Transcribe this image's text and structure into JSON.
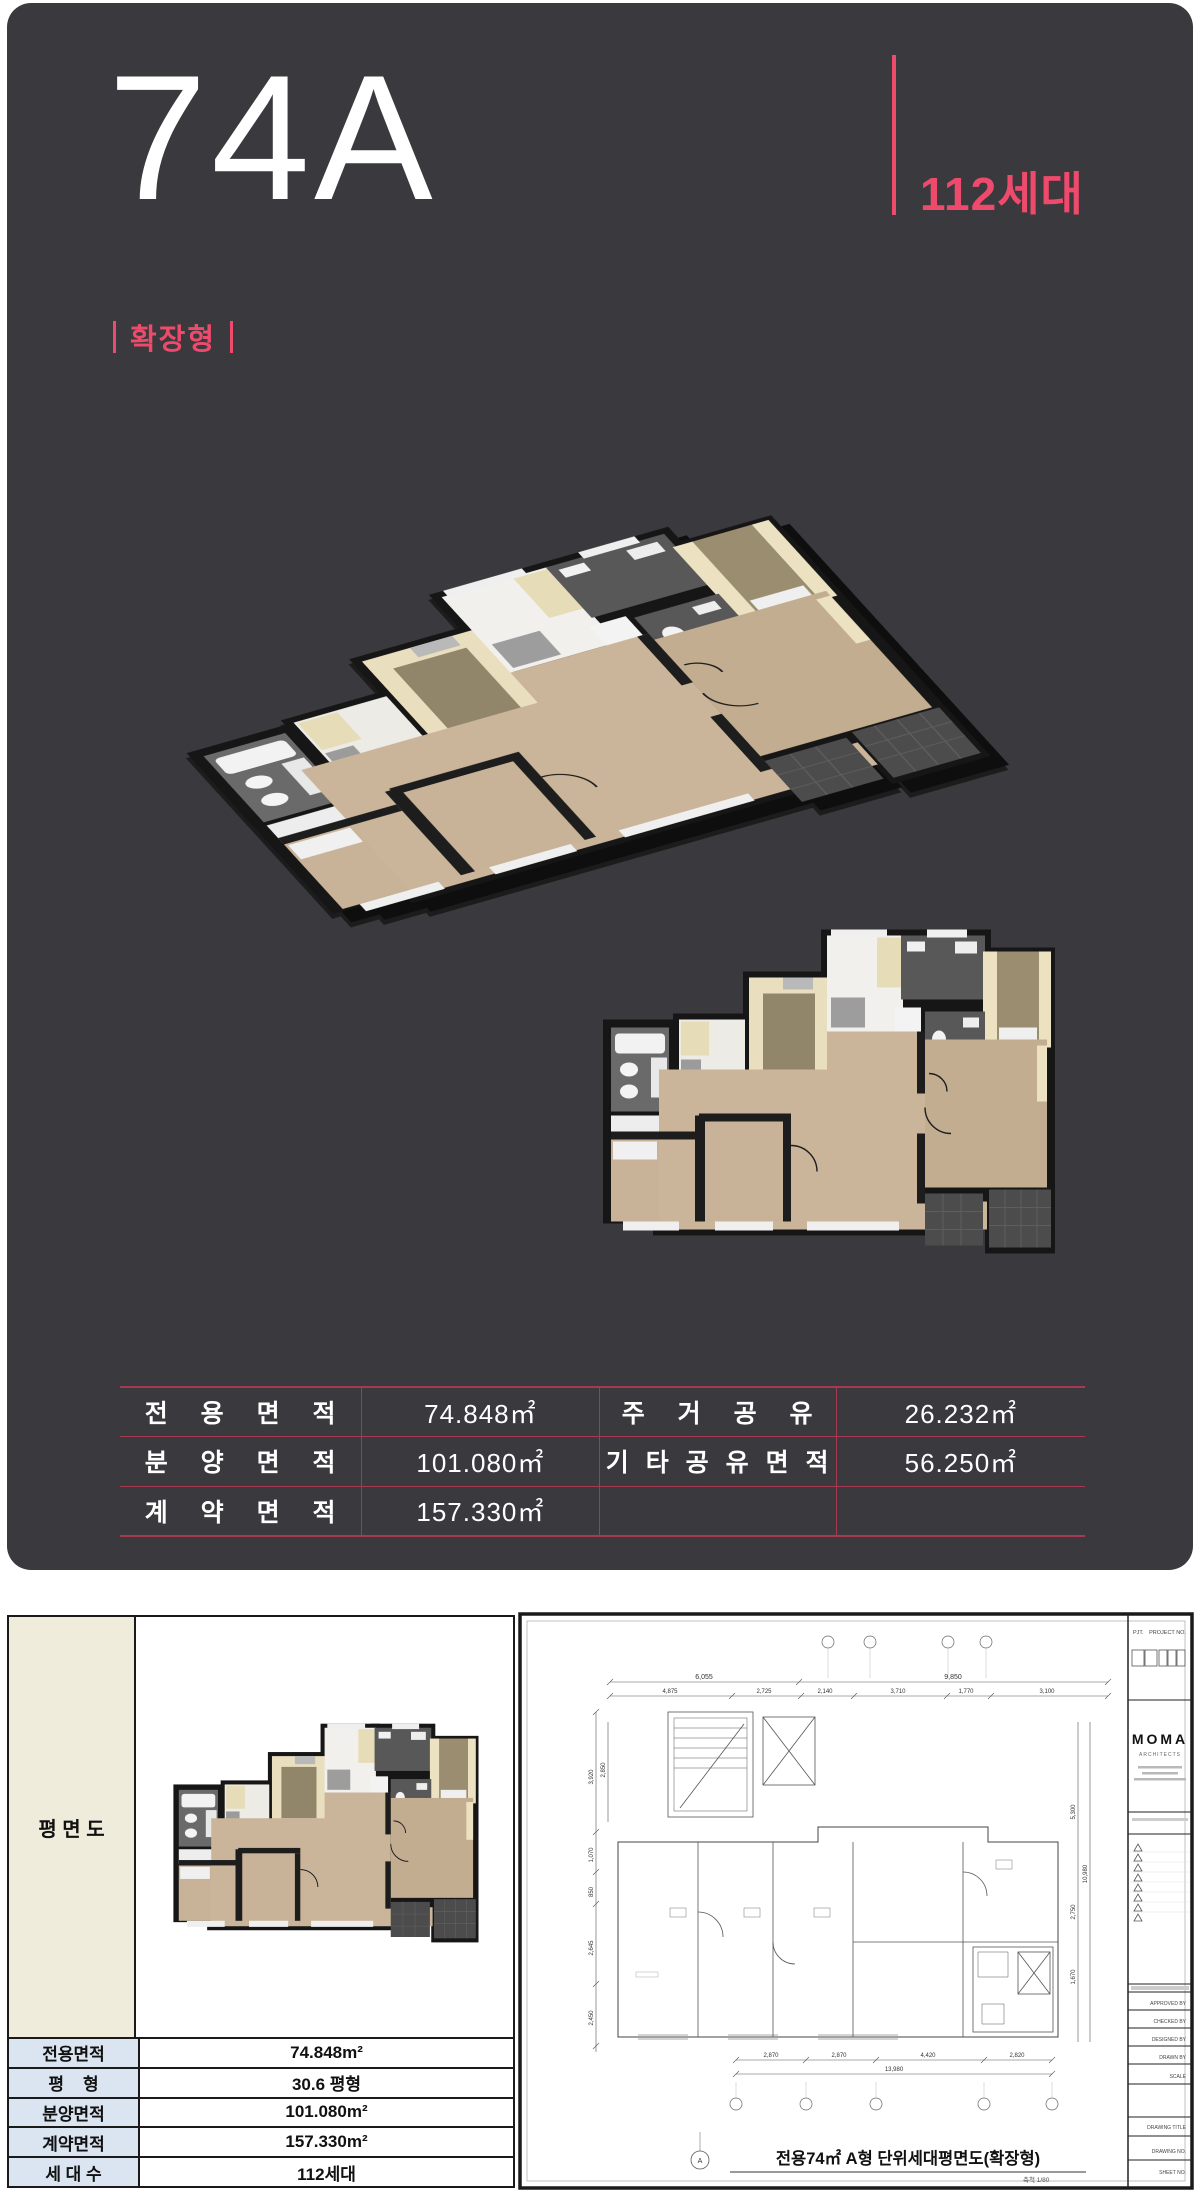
{
  "header": {
    "unit_type": "74A",
    "units_badge": "112세대",
    "plan_variant": "확장형"
  },
  "colors": {
    "accent_pink": "#ee4a6b",
    "panel_dark": "#3a393d",
    "table_line": "#a63a52",
    "spec_label_cell": "#dbe5f1",
    "plan_label_cell": "#efecdb"
  },
  "area_table": {
    "rows": [
      {
        "label1": "전 용 면 적",
        "value1": "74.848㎡",
        "label2": "주 거 공 유",
        "value2": "26.232㎡"
      },
      {
        "label1": "분 양 면 적",
        "value1": "101.080㎡",
        "label2": "기 타 공 유 면 적",
        "value2": "56.250㎡"
      },
      {
        "label1": "계 약 면 적",
        "value1": "157.330㎡",
        "label2": "",
        "value2": ""
      }
    ]
  },
  "spec_table": {
    "plan_label": "평 면 도",
    "rows": [
      {
        "label": "전용면적",
        "value": "74.848m²"
      },
      {
        "label": "평    형",
        "value": "30.6 평형"
      },
      {
        "label": "분양면적",
        "value": "101.080m²"
      },
      {
        "label": "계약면적",
        "value": "157.330m²"
      },
      {
        "label": "세 대 수",
        "value": "112세대"
      }
    ]
  },
  "drawing": {
    "caption": "전용74㎡ A형 단위세대평면도(확장형)",
    "scale_note": "축척 1/80",
    "grid_bubble": "A",
    "dims_top": [
      "6,055",
      "9,850"
    ],
    "dims_top2": [
      "4,875",
      "2,725",
      "2,140",
      "3,710",
      "1,770",
      "3,100"
    ],
    "dims_left": [
      "3,920",
      "2,850",
      "1,070",
      "850",
      "2,645",
      "2,450"
    ],
    "dims_right": [
      "5,300",
      "2,750",
      "1,670",
      "10,980"
    ],
    "dims_bottom": [
      "2,870",
      "2,870",
      "4,420",
      "2,820"
    ],
    "dims_bottom_total": "13,980",
    "titleblock": {
      "pjt": "PJT.",
      "project_no": "PROJECT NO.",
      "logo": "MOMA",
      "logo_sub": "ARCHITECTS",
      "fields": [
        "APPROVED BY",
        "CHECKED BY",
        "DESIGNED BY",
        "DRAWN BY",
        "SCALE",
        "DRAWING TITLE",
        "DRAWING NO.",
        "SHEET NO."
      ]
    }
  }
}
